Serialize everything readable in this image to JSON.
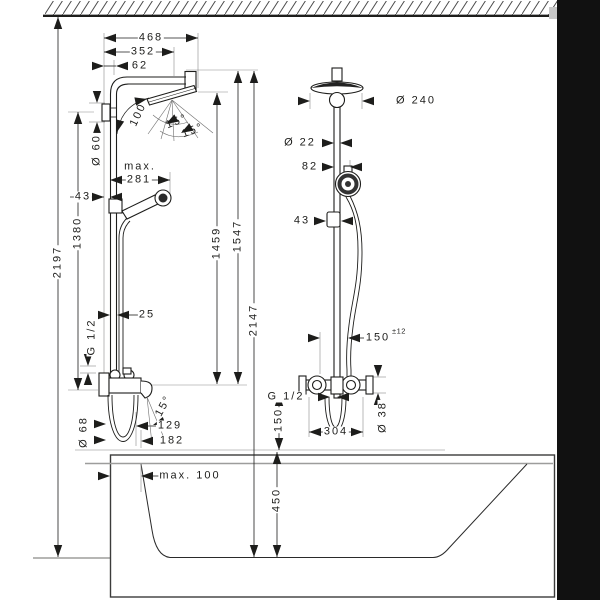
{
  "drawing_type": "shower-system-installation-diagram",
  "colors": {
    "line": "#1d1d1b",
    "gray_line": "#9d9d9c",
    "wall_fill": "#111111"
  },
  "structure": {
    "ceiling": "hatched-band-top",
    "right_wall": "solid-black-bar",
    "bathtub": "section-outline-bottom"
  },
  "dims": {
    "width_full": "468",
    "width_arm": "352",
    "width_pipe_offset": "62",
    "arm_angle": "100°",
    "spray_angle_a": "15°",
    "spray_angle_b": "15°",
    "bracket_dia": "Ø 60",
    "max_label": "max.",
    "reach_max": "281",
    "wall_to_pipe": "43",
    "bracket_height": "1380",
    "total_height": "2197",
    "pipe_dia": "25",
    "thread_left": "G 1/2",
    "escutcheon_dia": "Ø 68",
    "spout_reach": "129",
    "spout_reach_outer": "182",
    "spout_angle": "15°",
    "handshower_height": "1459",
    "pipe_top_height": "1547",
    "overall_height": "2147",
    "head_dia": "Ø 240",
    "riser_dia": "Ø 22",
    "handshower_offset": "82",
    "slider_offset": "43",
    "hose_clearance": "150",
    "hose_clearance_tol": "±12",
    "thread_right": "G 1/2",
    "valve_above_rim": "150",
    "valve_width": "304",
    "valve_dia": "Ø 38",
    "rim_height": "450",
    "tub_overhang": "max. 100"
  }
}
